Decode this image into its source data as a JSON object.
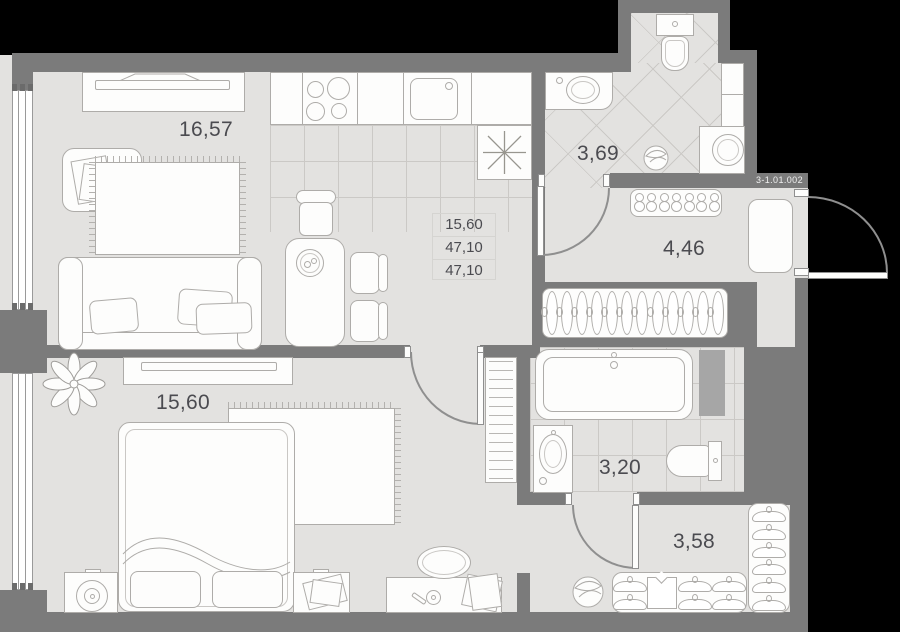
{
  "unit_label": "3-1.01.002",
  "rooms": {
    "living_kitchen": {
      "area": "16,57"
    },
    "bathroom_top": {
      "area": "3,69"
    },
    "hallway_entry": {
      "area": "4,46"
    },
    "bedroom": {
      "area": "15,60"
    },
    "bathroom_bottom": {
      "area": "3,20"
    },
    "hallway_wardrobe": {
      "area": "3,58"
    }
  },
  "info_box": {
    "rows": [
      "15,60",
      "47,10",
      "47,10"
    ]
  },
  "colors": {
    "background": "#000000",
    "wall": "#7b7b7b",
    "floor": "#e3e2e0",
    "tile_line": "#cbc9c6",
    "furniture_outline": "#aeaca9",
    "label_text": "#4b4b50",
    "unit_label_text": "#f0f0f0",
    "duct": "#a6a6a6",
    "door_arc": "#8f8f8f"
  }
}
